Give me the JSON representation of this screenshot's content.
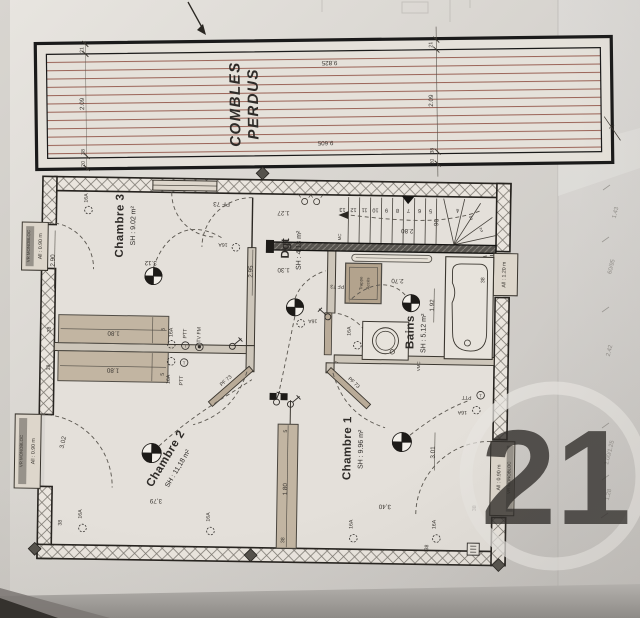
{
  "combles": {
    "title_line1": "COMBLES",
    "title_line2": "PERDUS",
    "dim_21": "21",
    "dim_209": "2.09",
    "dim_9825": "9.825",
    "dim_9605": "9.605",
    "dim_38": "38",
    "dim_20": "20"
  },
  "rooms": [
    {
      "name": "Chambre 3",
      "area": "SH : 9.02 m²"
    },
    {
      "name": "Dgt",
      "area": "SH : 4.18 m²"
    },
    {
      "name": "Bains",
      "area": "SH : 5.12 m²"
    },
    {
      "name": "Chambre 2",
      "area": "SH : 11,18 m²"
    },
    {
      "name": "Chambre 1",
      "area": "SH : 9.96 m²"
    }
  ],
  "stair": {
    "steps": [
      "13",
      "12",
      "11",
      "10",
      "9",
      "8",
      "7",
      "6",
      "5",
      "4",
      "3",
      "2"
    ],
    "width": "90",
    "depth": "2.80"
  },
  "openings": {
    "pf73": "PF 73",
    "vr_monobloc": "VR MONOBLOC",
    "all_090": "All : 0.90 m",
    "all_120": "All : 1.20 m",
    "trappe_line1": "Trappe",
    "trappe_line2": "Accès",
    "vmc": "VMC",
    "mc": "MC"
  },
  "electrical": {
    "socket": "16A",
    "phone": "PTT",
    "tv": "TV FM",
    "t_symbol": "T"
  },
  "dims": {
    "d290": "2.90",
    "d295": "2.95",
    "d312": "3.12",
    "d127": "1.27",
    "d130": "1.30",
    "d270": "2.70",
    "d192": "1.92",
    "d302": "3.02",
    "d379": "3,79",
    "d340": "3,40",
    "d301": "3.01",
    "d180": "1.80",
    "d38": "38",
    "d5": "5",
    "d7": "7"
  },
  "margin_notes": {
    "n1": "1.43",
    "n2": "60/95",
    "n3": "2.42",
    "n4": "1.00/1.25",
    "n5": "1.28"
  },
  "watermark": {
    "number": "21"
  },
  "colors": {
    "ink": "#2e2b28",
    "roof_hatch": "#9c665a",
    "wood": "#c2b5a2",
    "watermark": "#e7e5e1"
  }
}
